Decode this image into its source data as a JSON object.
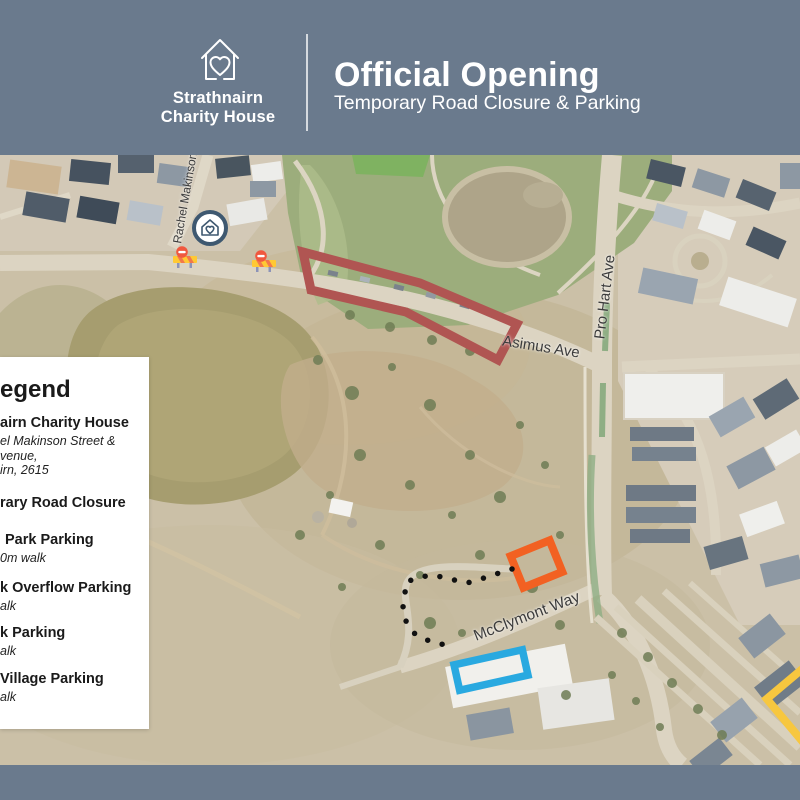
{
  "colors": {
    "header_bg": "#6A7A8D",
    "legend_bg": "#FFFFFF",
    "road_closure_outline": "#B05552",
    "orange_parking_outline": "#F26122",
    "blue_parking_outline": "#29A9E0",
    "yellow_parking_outline": "#F7C73F",
    "walking_route_dots": "#111111",
    "venue_marker_ring": "#3E5870"
  },
  "header": {
    "org_name_line1": "Strathnairn",
    "org_name_line2": "Charity House",
    "title": "Official Opening",
    "subtitle": "Temporary Road Closure & Parking"
  },
  "map": {
    "street_labels": {
      "rachel_makinson": "Rachel Makinson",
      "pro_hart": "Pro Hart Ave",
      "asimus": "Asimus Ave",
      "mcclymont": "McClymont Way"
    }
  },
  "legend": {
    "title": "egend",
    "items": [
      {
        "name": "airn Charity House",
        "details": [
          "el Makinson Street &",
          "venue,",
          "irn, 2615"
        ]
      },
      {
        "name": "rary Road Closure",
        "details": []
      },
      {
        "name": "Park Parking",
        "details": [
          "0m walk"
        ]
      },
      {
        "name": "k Overflow Parking",
        "details": [
          "alk"
        ]
      },
      {
        "name": "k Parking",
        "details": [
          "alk"
        ]
      },
      {
        "name": "Village Parking",
        "details": [
          "alk"
        ]
      }
    ]
  }
}
